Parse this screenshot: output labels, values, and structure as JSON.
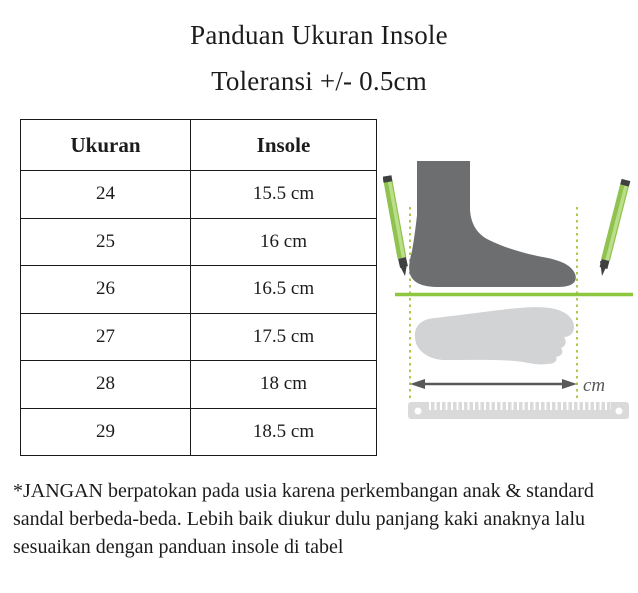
{
  "page": {
    "title": "Panduan Ukuran Insole",
    "subtitle": "Toleransi +/- 0.5cm"
  },
  "table": {
    "headers": [
      "Ukuran",
      "Insole"
    ],
    "rows": [
      [
        "24",
        "15.5 cm"
      ],
      [
        "25",
        "16 cm"
      ],
      [
        "26",
        "16.5 cm"
      ],
      [
        "27",
        "17.5 cm"
      ],
      [
        "28",
        "18 cm"
      ],
      [
        "29",
        "18.5 cm"
      ]
    ]
  },
  "illustration": {
    "unit_label": "cm",
    "colors": {
      "foot": "#6d6e70",
      "footprint": "#d2d3d5",
      "pencil_body": "#8fc24f",
      "pencil_highlight": "#bbde88",
      "pencil_dark": "#3f4040",
      "guide_green": "#a9c94f",
      "ground_green": "#8dc63f",
      "arrow_gray": "#58595b",
      "ruler_gray": "#dadada",
      "table_border": "#1a1a1a",
      "text": "#1c1c1c"
    }
  },
  "note": {
    "lines": [
      "*JANGAN berpatokan pada usia karena perkembangan anak & standard",
      "sandal berbeda-beda. Lebih baik diukur dulu panjang kaki anaknya lalu",
      "sesuaikan dengan panduan insole di tabel"
    ]
  }
}
